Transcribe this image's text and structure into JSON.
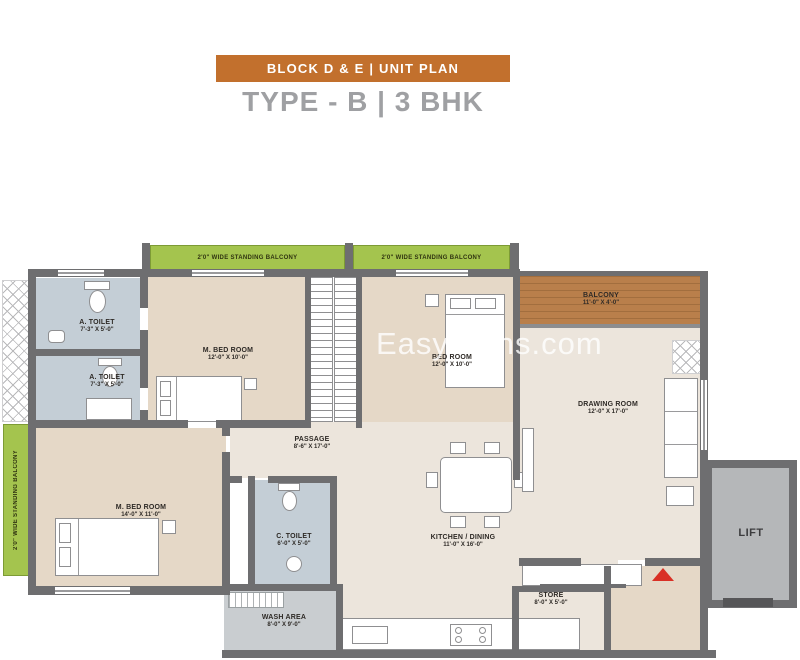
{
  "header": {
    "banner": "BLOCK D & E  |  UNIT PLAN",
    "title": "TYPE - B  |  3 BHK"
  },
  "watermark": "EasyPlans.com",
  "balconies": {
    "top_left": "2'0\" WIDE STANDING BALCONY",
    "top_right": "2'0\" WIDE STANDING BALCONY",
    "left": "2'0\" WIDE STANDING BALCONY"
  },
  "rooms": {
    "a_toilet_1": {
      "name": "A. TOILET",
      "dim": "7'-3\" X 5'-0\""
    },
    "a_toilet_2": {
      "name": "A. TOILET",
      "dim": "7'-3\" X 5'-0\""
    },
    "m_bed_room_top": {
      "name": "M. BED ROOM",
      "dim": "12'-0\" X 10'-0\""
    },
    "bed_room": {
      "name": "BED ROOM",
      "dim": "12'-0\" X 10'-0\""
    },
    "balcony": {
      "name": "BALCONY",
      "dim": "11'-0\" X 4'-0\""
    },
    "drawing_room": {
      "name": "DRAWING ROOM",
      "dim": "12'-0\" X 17'-0\""
    },
    "passage": {
      "name": "PASSAGE",
      "dim": "8'-6\" X 17'-0\""
    },
    "m_bed_room_bottom": {
      "name": "M. BED ROOM",
      "dim": "14'-0\" X 11'-0\""
    },
    "c_toilet": {
      "name": "C. TOILET",
      "dim": "6'-0\" X 5'-0\""
    },
    "kitchen_dining": {
      "name": "KITCHEN / DINING",
      "dim": "11'-0\" X 16'-0\""
    },
    "store": {
      "name": "STORE",
      "dim": "8'-0\" X 5'-0\""
    },
    "wash_area": {
      "name": "WASH AREA",
      "dim": "8'-0\" X 9'-0\""
    },
    "lift": {
      "name": "LIFT"
    }
  },
  "colors": {
    "banner_bg": "#c2702d",
    "title_text": "#9fa0a3",
    "wall": "#6e6e70",
    "floor_cream": "#ece5dc",
    "floor_tan": "#e5d8c7",
    "floor_toilet": "#c4ced6",
    "floor_wash": "#c9cdd0",
    "balcony_green": "#a4c44e",
    "balcony_wood": "#b97f4b",
    "lift_gray": "#b5b7b9",
    "entry_arrow_red": "#d93025"
  }
}
